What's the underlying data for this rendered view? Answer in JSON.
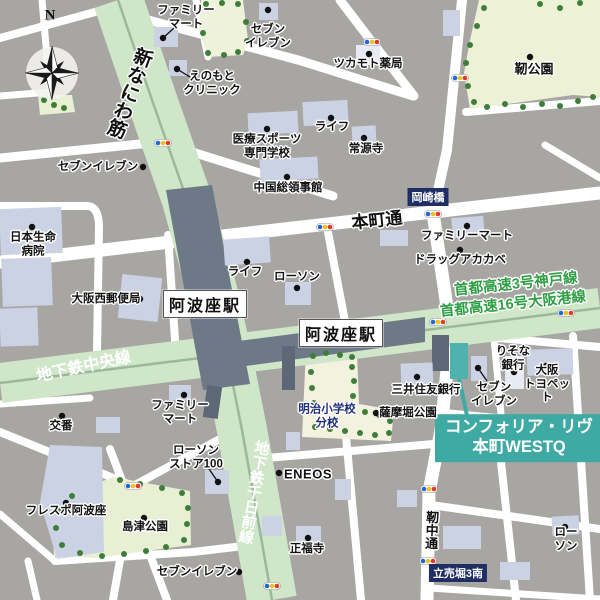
{
  "title": "コンフォリア・リヴ本町WESTQ 周辺地図",
  "compass": {
    "label": "N"
  },
  "stations": {
    "awaza_1": "阿波座駅",
    "awaza_2": "阿波座駅"
  },
  "roads": {
    "shin_naniwa": "新なにわ筋",
    "chuo_line": "地下鉄中央線",
    "sennichimae_line": "地下鉄千日前線",
    "honmachi": "本町通",
    "utsubo_naka": "靭中通",
    "expressway_kobe": "首都高速3号神戸線",
    "expressway_osakako": "首都高速16号大阪港線"
  },
  "signs": {
    "okazakibashi": "岡崎橋",
    "itachibori_3_minami": "立売堀3南"
  },
  "property": {
    "name_line1": "コンフォリア・リヴ",
    "name_line2": "本町WESTQ"
  },
  "labels": {
    "famima_top": "ファミリー\nマート",
    "seven_top": "セブン\nイレブン",
    "enomoto_clinic": "えのもと\nクリニック",
    "tsukamoto_pharmacy": "ツカモト薬局",
    "utsubo_park": "靭公園",
    "iryo_sports_school": "医療スポーツ\n専門学校",
    "china_consulate": "中国総領事館",
    "life_upper": "ライフ",
    "jogenji": "常源寺",
    "seven_left": "セブンイレブン",
    "nippon_life_hospital": "日本生命\n病院",
    "osaka_nishi_post": "大阪西郵便局",
    "famima_honmachi": "ファミリーマート",
    "drug_akakabe": "ドラッグアカカベ",
    "life_center": "ライフ",
    "lawson_center": "ローソン",
    "smbc_bank": "三井住友銀行",
    "seven_center": "セブン\nイレブン",
    "resona_bank": "りそな\n銀行",
    "osaka_toyopet": "大阪\nトヨペット",
    "meiji_school_branch": "明治小学校\n分校",
    "satsumabori_park": "薩摩堀公園",
    "eneos": "ENEOS",
    "koban": "交番",
    "famima_bottom": "ファミリー\nマート",
    "lawson_store100": "ローソン\nストア100",
    "frespo_awaza": "フレスポ阿波座",
    "shimazu_park": "島津公園",
    "seven_bottom": "セブンイレブン",
    "shofukuji": "正福寺",
    "lawson_bottom_right": "ローソン"
  },
  "colors": {
    "background_gray": "#a8a6a3",
    "road_white": "#ffffff",
    "main_road_green": "#cfe7c8",
    "road_centerline": "#9bb89b",
    "park_green": "#ebf0d4",
    "schoolyard_cream": "#f3f2de",
    "building_blue": "#cbd2e4",
    "station_slab": "#6e7988",
    "accent_teal": "#3fa9a3",
    "sign_navy": "#1f2e63",
    "expressway_text_green": "#2f9e45",
    "tree_green": "#3f7d3a",
    "signal_blue": "#2563d6",
    "signal_yellow": "#f3c01c",
    "signal_red": "#e23a28"
  }
}
